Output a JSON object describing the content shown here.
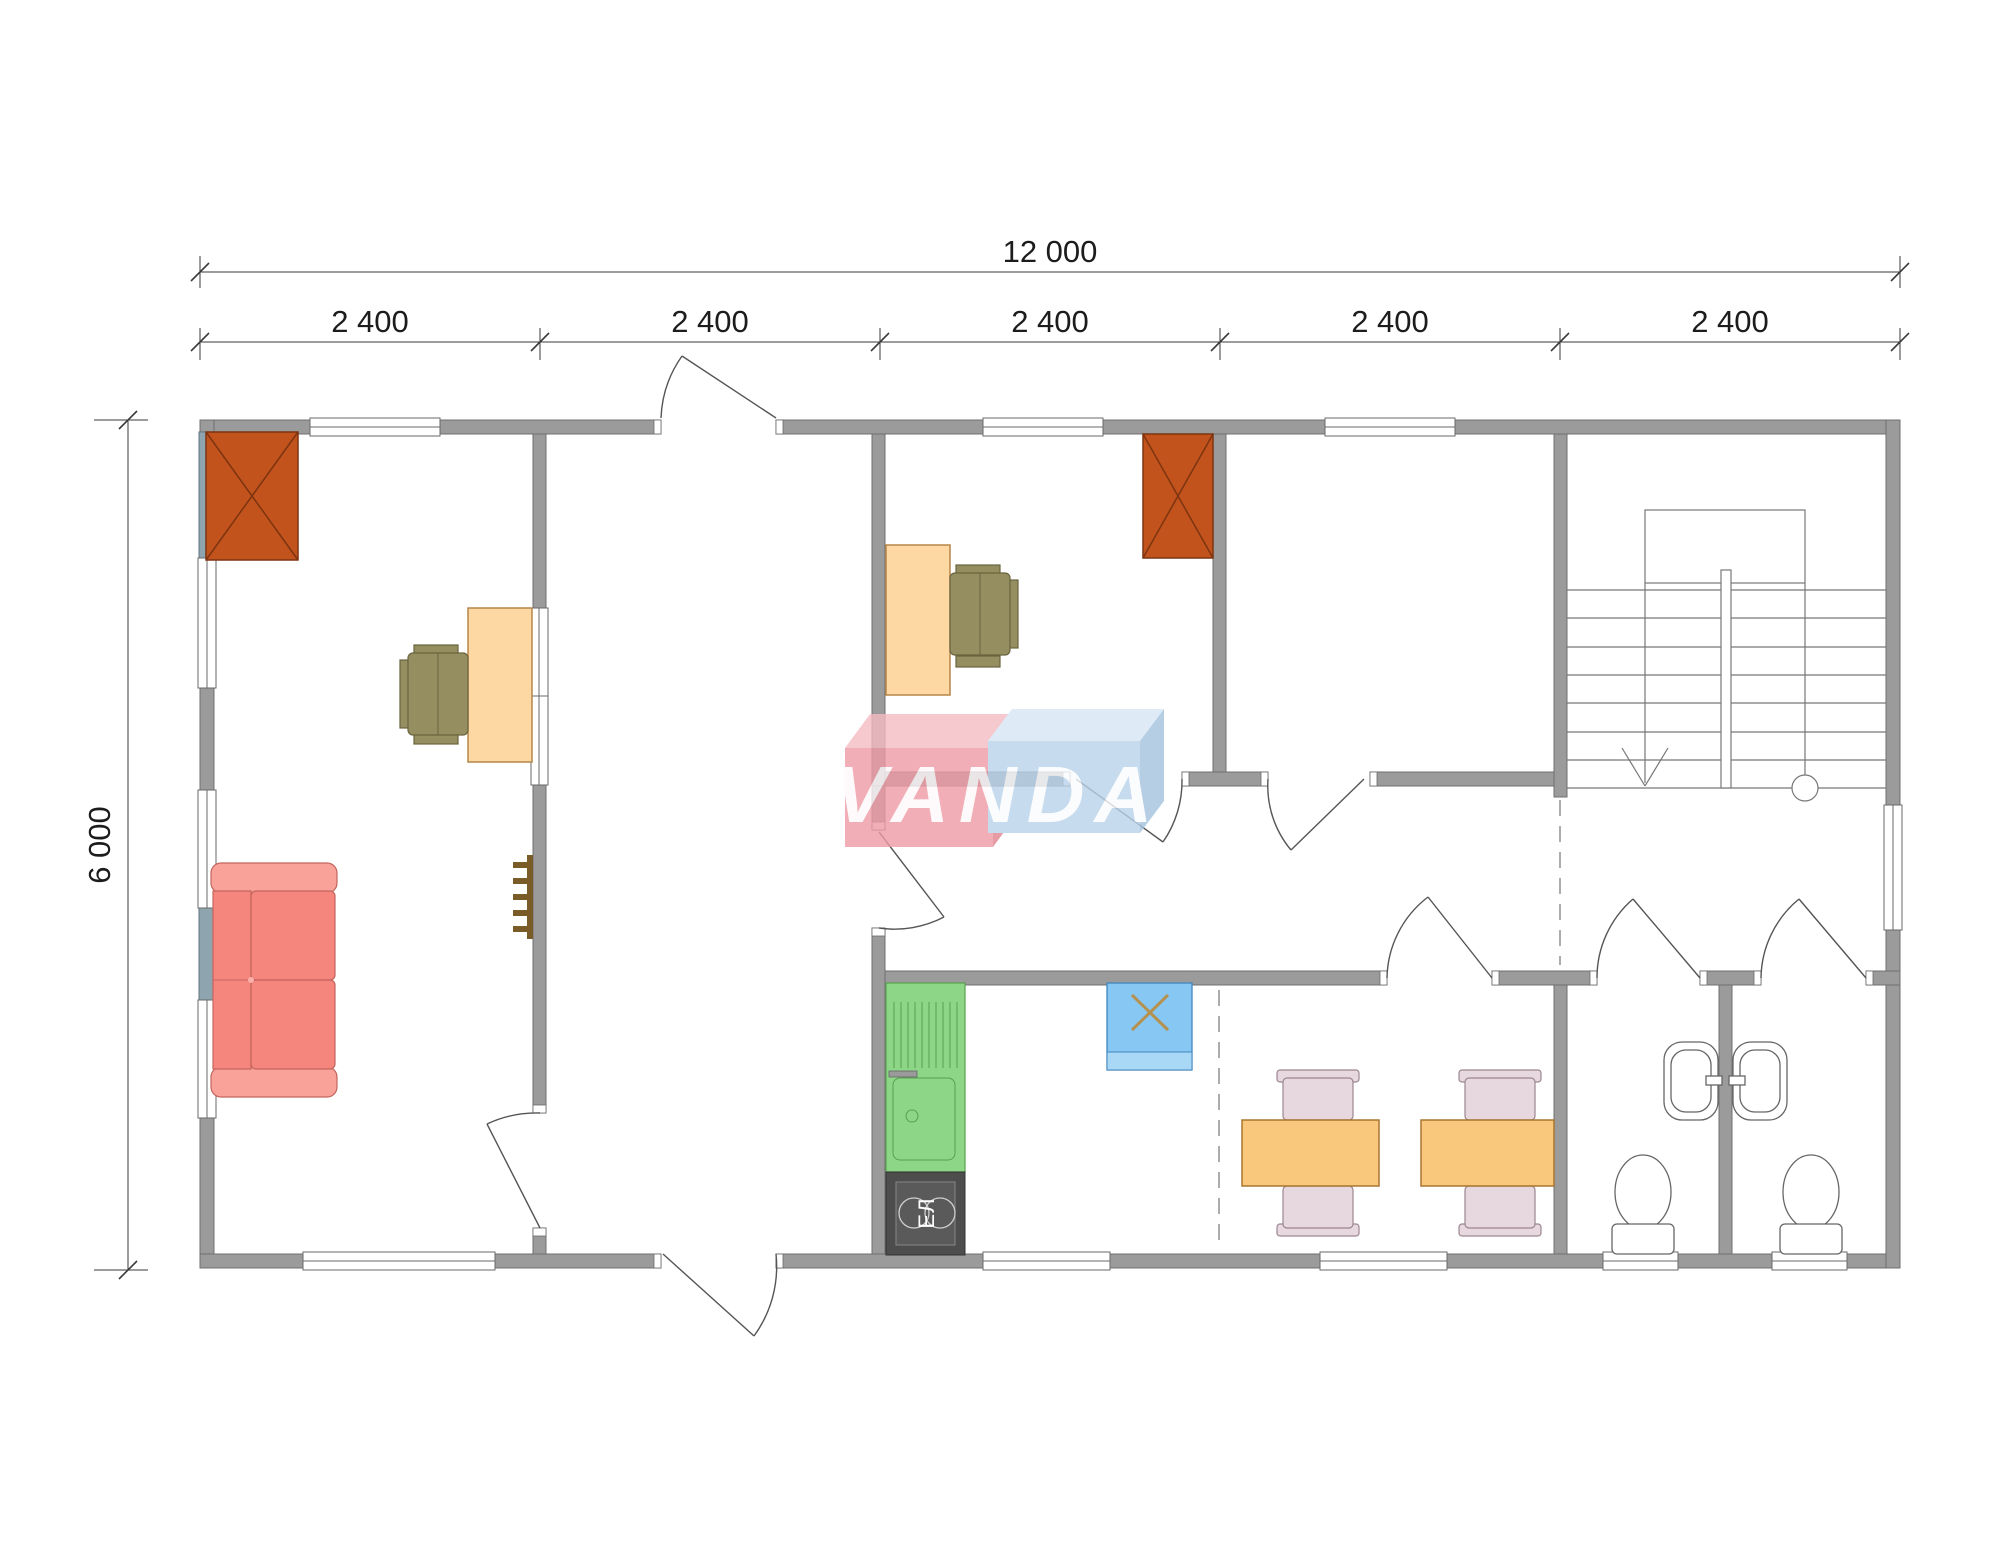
{
  "drawing": {
    "type": "floor-plan",
    "dimensions": {
      "overall_width": "12 000",
      "overall_depth": "6 000",
      "modules": [
        "2 400",
        "2 400",
        "2 400",
        "2 400",
        "2 400"
      ]
    },
    "labels": {
      "stove": "ЕЛ"
    },
    "watermark": {
      "text": "VANDA"
    },
    "colors": {
      "wall": "#9b9b9b",
      "wall_edge": "#6f6f6f",
      "slate_panel": "#8ea4ae",
      "wardrobe": "#c2531c",
      "wardrobe_edge": "#7d3410",
      "desk": "#fdd8a2",
      "desk_edge": "#b5854a",
      "chair": "#958e60",
      "chair_edge": "#6a643f",
      "sofa": "#f5867e",
      "sofa_light": "#f8a29a",
      "sofa_edge": "#c4655e",
      "table": "#f9c87d",
      "table_edge": "#a8762e",
      "dining_chair": "#e7d7de",
      "dining_chair_edge": "#9b8690",
      "kitchen": "#8ed687",
      "kitchen_edge": "#55a04e",
      "stove": "#4d4d4d",
      "fridge": "#87c7f3",
      "fridge_edge": "#4186bd",
      "fridge_band": "#a9d8f7",
      "fridge_x": "#b5914f",
      "stair_line": "#777777",
      "logo_red": "#ef9aa4",
      "logo_red_top": "#f5bcc2",
      "logo_red_side": "#e2848f",
      "logo_blue": "#b9d3eb",
      "logo_blue_top": "#d6e5f4",
      "logo_blue_side": "#a4c2de"
    }
  }
}
